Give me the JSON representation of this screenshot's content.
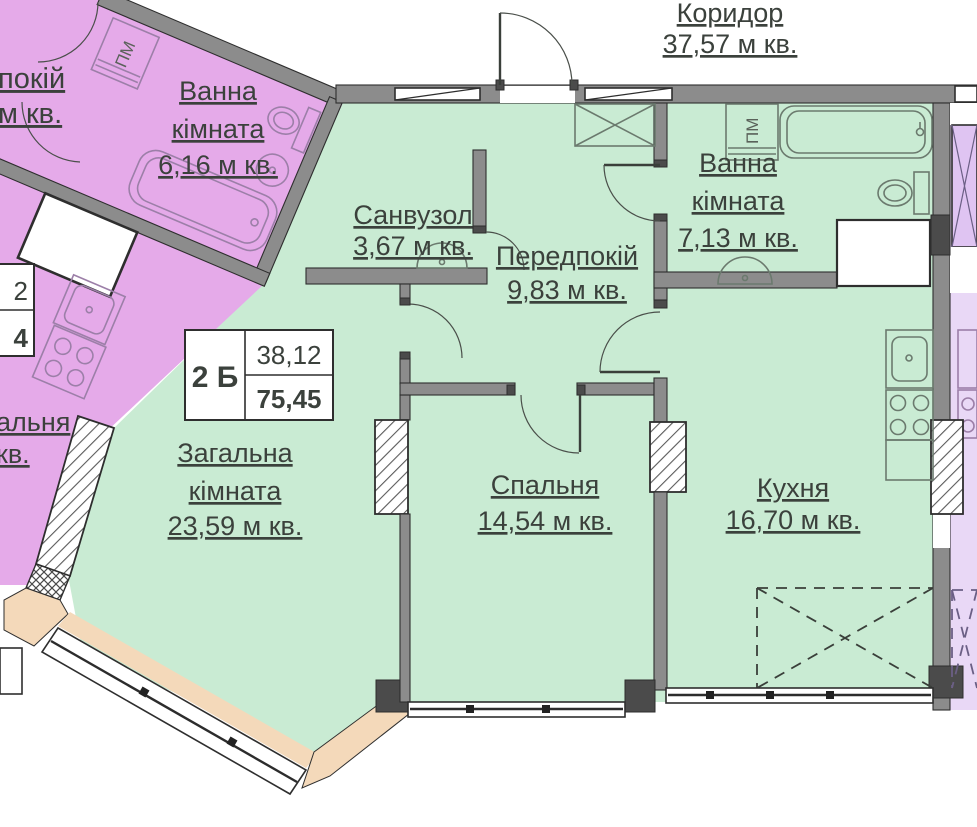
{
  "plan": {
    "corridor": {
      "name": "Коридор",
      "area": "37,57 м кв."
    },
    "unit_label": {
      "code": "2 Б",
      "value_top": "38,12",
      "value_bottom": "75,45"
    },
    "rooms": {
      "sanvuzol": {
        "name": "Санвузол",
        "area": "3,67 м кв."
      },
      "hall": {
        "name": "Передпокій",
        "area": "9,83 м кв."
      },
      "bath": {
        "line1": "Ванна",
        "line2": "кімната",
        "area": "7,13 м кв."
      },
      "living": {
        "line1": "Загальна",
        "line2": "кімната",
        "area": "23,59 м кв."
      },
      "bedroom": {
        "name": "Спальня",
        "area": "14,54 м кв."
      },
      "kitchen": {
        "name": "Кухня",
        "area": "16,70 м кв."
      }
    },
    "neighbor_left": {
      "bath": {
        "line1": "Ванна",
        "line2": "кімната",
        "area": "6,16 м кв."
      },
      "partial_room_top": {
        "line1": "покій",
        "line2": "м кв."
      },
      "partial_room_bottom": {
        "line1": "альня",
        "line2": "кв."
      },
      "partial_label": {
        "top": "2",
        "bottom": "4"
      }
    },
    "appliances": {
      "washer": "ПМ"
    }
  },
  "colors": {
    "mint": "#c9ebd3",
    "purple": "#e5aae9",
    "lavender": "#e9d8f6",
    "wall": "#8c8c8c",
    "column": "#4b4b4b",
    "peach": "#f4d9ba",
    "ink": "#3b413c",
    "line": "#2e2e2e",
    "fixture": "#6b7a6e",
    "pfixture": "#9c7fa8"
  }
}
